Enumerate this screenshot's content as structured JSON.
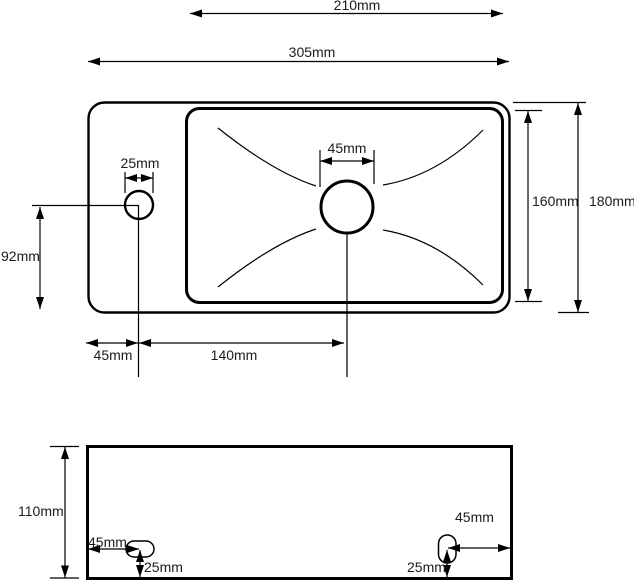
{
  "drawing": {
    "units": "mm",
    "colors": {
      "line": "#000000",
      "background": "#ffffff",
      "text": "#1b1b1b"
    },
    "top_view": {
      "dim_basin_width": "210mm",
      "dim_overall_width": "305mm",
      "dim_tap_hole_diameter": "25mm",
      "dim_drain_hole_diameter": "45mm",
      "dim_basin_depth": "160mm",
      "dim_overall_depth": "180mm",
      "dim_tap_center_from_bottom": "92mm",
      "dim_tap_center_from_left": "45mm",
      "dim_tap_to_drain_center": "140mm"
    },
    "bottom_view": {
      "dim_height": "110mm",
      "dim_left_slot_from_left": "45mm",
      "dim_left_slot_from_bottom": "25mm",
      "dim_right_slot_from_right": "45mm",
      "dim_right_slot_from_bottom": "25mm"
    }
  }
}
